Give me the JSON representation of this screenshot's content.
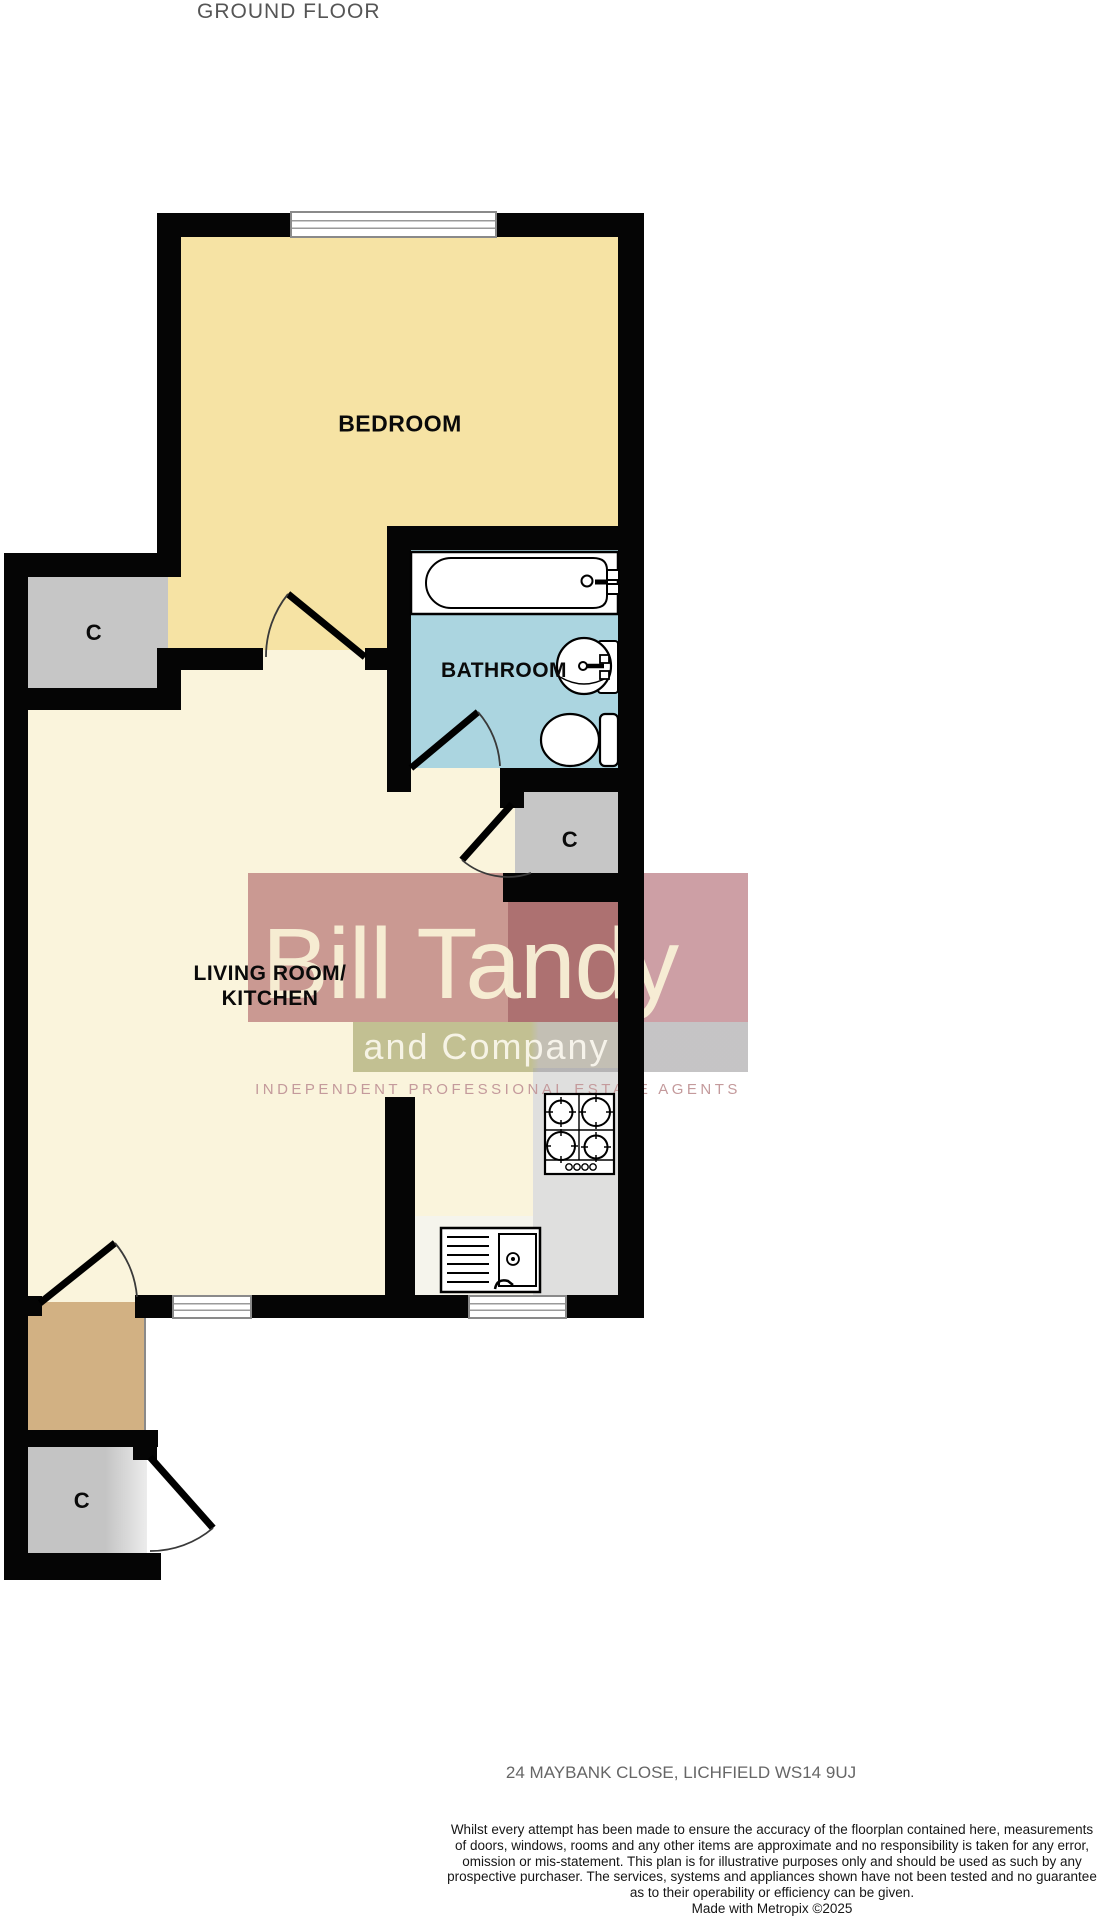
{
  "title": "GROUND FLOOR",
  "rooms": {
    "bedroom": {
      "label": "BEDROOM"
    },
    "bathroom": {
      "label": "BATHROOM"
    },
    "living_kitchen": {
      "label_line1": "LIVING ROOM/",
      "label_line2": "KITCHEN"
    },
    "closet": {
      "label": "C"
    }
  },
  "fixtures": [
    "bathtub-icon",
    "basin-icon",
    "toilet-icon",
    "hob-icon",
    "kitchen-sink-icon",
    "window-icon",
    "door-arc-icon"
  ],
  "colors": {
    "wall": "#050505",
    "bedroom_floor": "#F6E3A4",
    "living_floor": "#FAF4DC",
    "bathroom_floor": "#ABD5E0",
    "closet_floor": "#C6C6C6",
    "hall_floor": "#D2B183",
    "counter": "#DFDFDE",
    "watermark_red": "#943240",
    "watermark_band": "#969655",
    "title_gray": "#555555"
  },
  "watermark": {
    "brand_line1": "Bill Tandy",
    "brand_line2": "and Company",
    "tagline": "INDEPENDENT PROFESSIONAL ESTATE AGENTS"
  },
  "footer": {
    "address": "24 MAYBANK CLOSE, LICHFIELD WS14 9UJ",
    "disclaimer_lines": [
      "Whilst every attempt has been made to ensure the accuracy of the floorplan contained here, measurements",
      "of doors, windows, rooms and any other items are approximate and no responsibility is taken for any error,",
      "omission or mis-statement. This plan is for illustrative purposes only and should be used as such by any",
      "prospective purchaser. The services, systems and appliances shown have not been tested and no guarantee",
      "as to their operability or efficiency can be given."
    ],
    "credit": "Made with Metropix ©2025"
  }
}
